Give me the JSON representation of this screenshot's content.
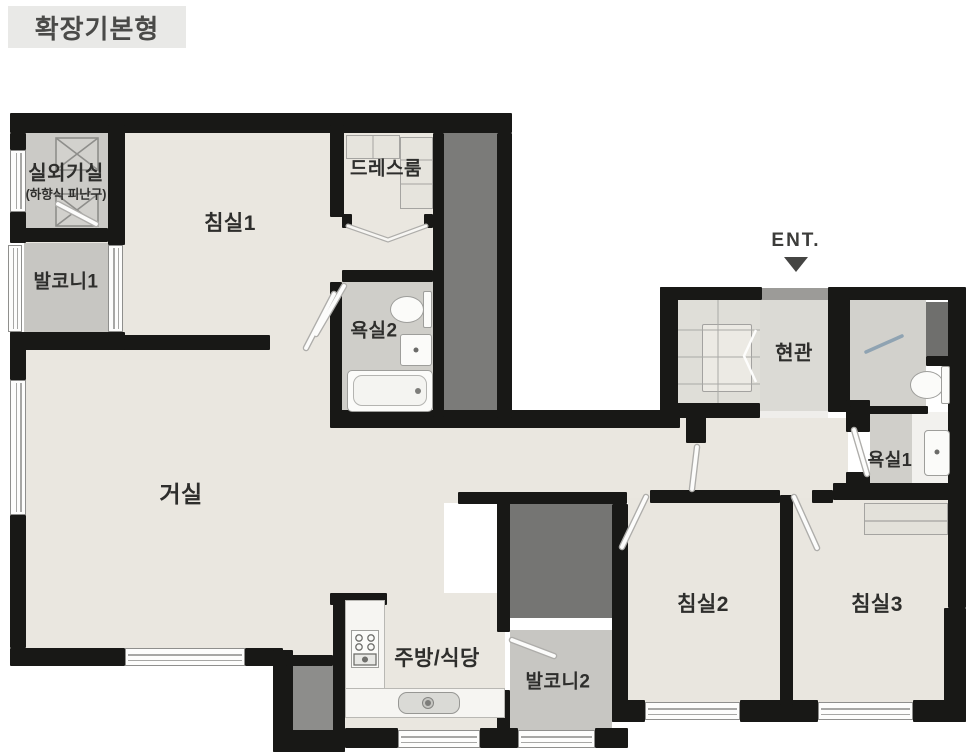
{
  "title": "확장기본형",
  "entrance": {
    "label": "ENT."
  },
  "rooms": {
    "outdoor_unit": {
      "label": "실외기실",
      "sublabel": "(하향식 피난구)"
    },
    "bedroom1": {
      "label": "침실1"
    },
    "dressroom": {
      "label": "드레스룸"
    },
    "balcony1": {
      "label": "발코니1"
    },
    "bath2": {
      "label": "욕실2"
    },
    "living": {
      "label": "거실"
    },
    "entry": {
      "label": "현관"
    },
    "bath1": {
      "label": "욕실1"
    },
    "bedroom2": {
      "label": "침실2"
    },
    "bedroom3": {
      "label": "침실3"
    },
    "kitchen": {
      "label": "주방/식당"
    },
    "balcony2": {
      "label": "발코니2"
    }
  },
  "colors": {
    "wall": "#181816",
    "floor": "#eae7e0",
    "service_floor": "#cbcac6",
    "shaft": "#7b7b79",
    "badge_bg": "#e9e9e7",
    "label_text": "#2e2e2c"
  }
}
